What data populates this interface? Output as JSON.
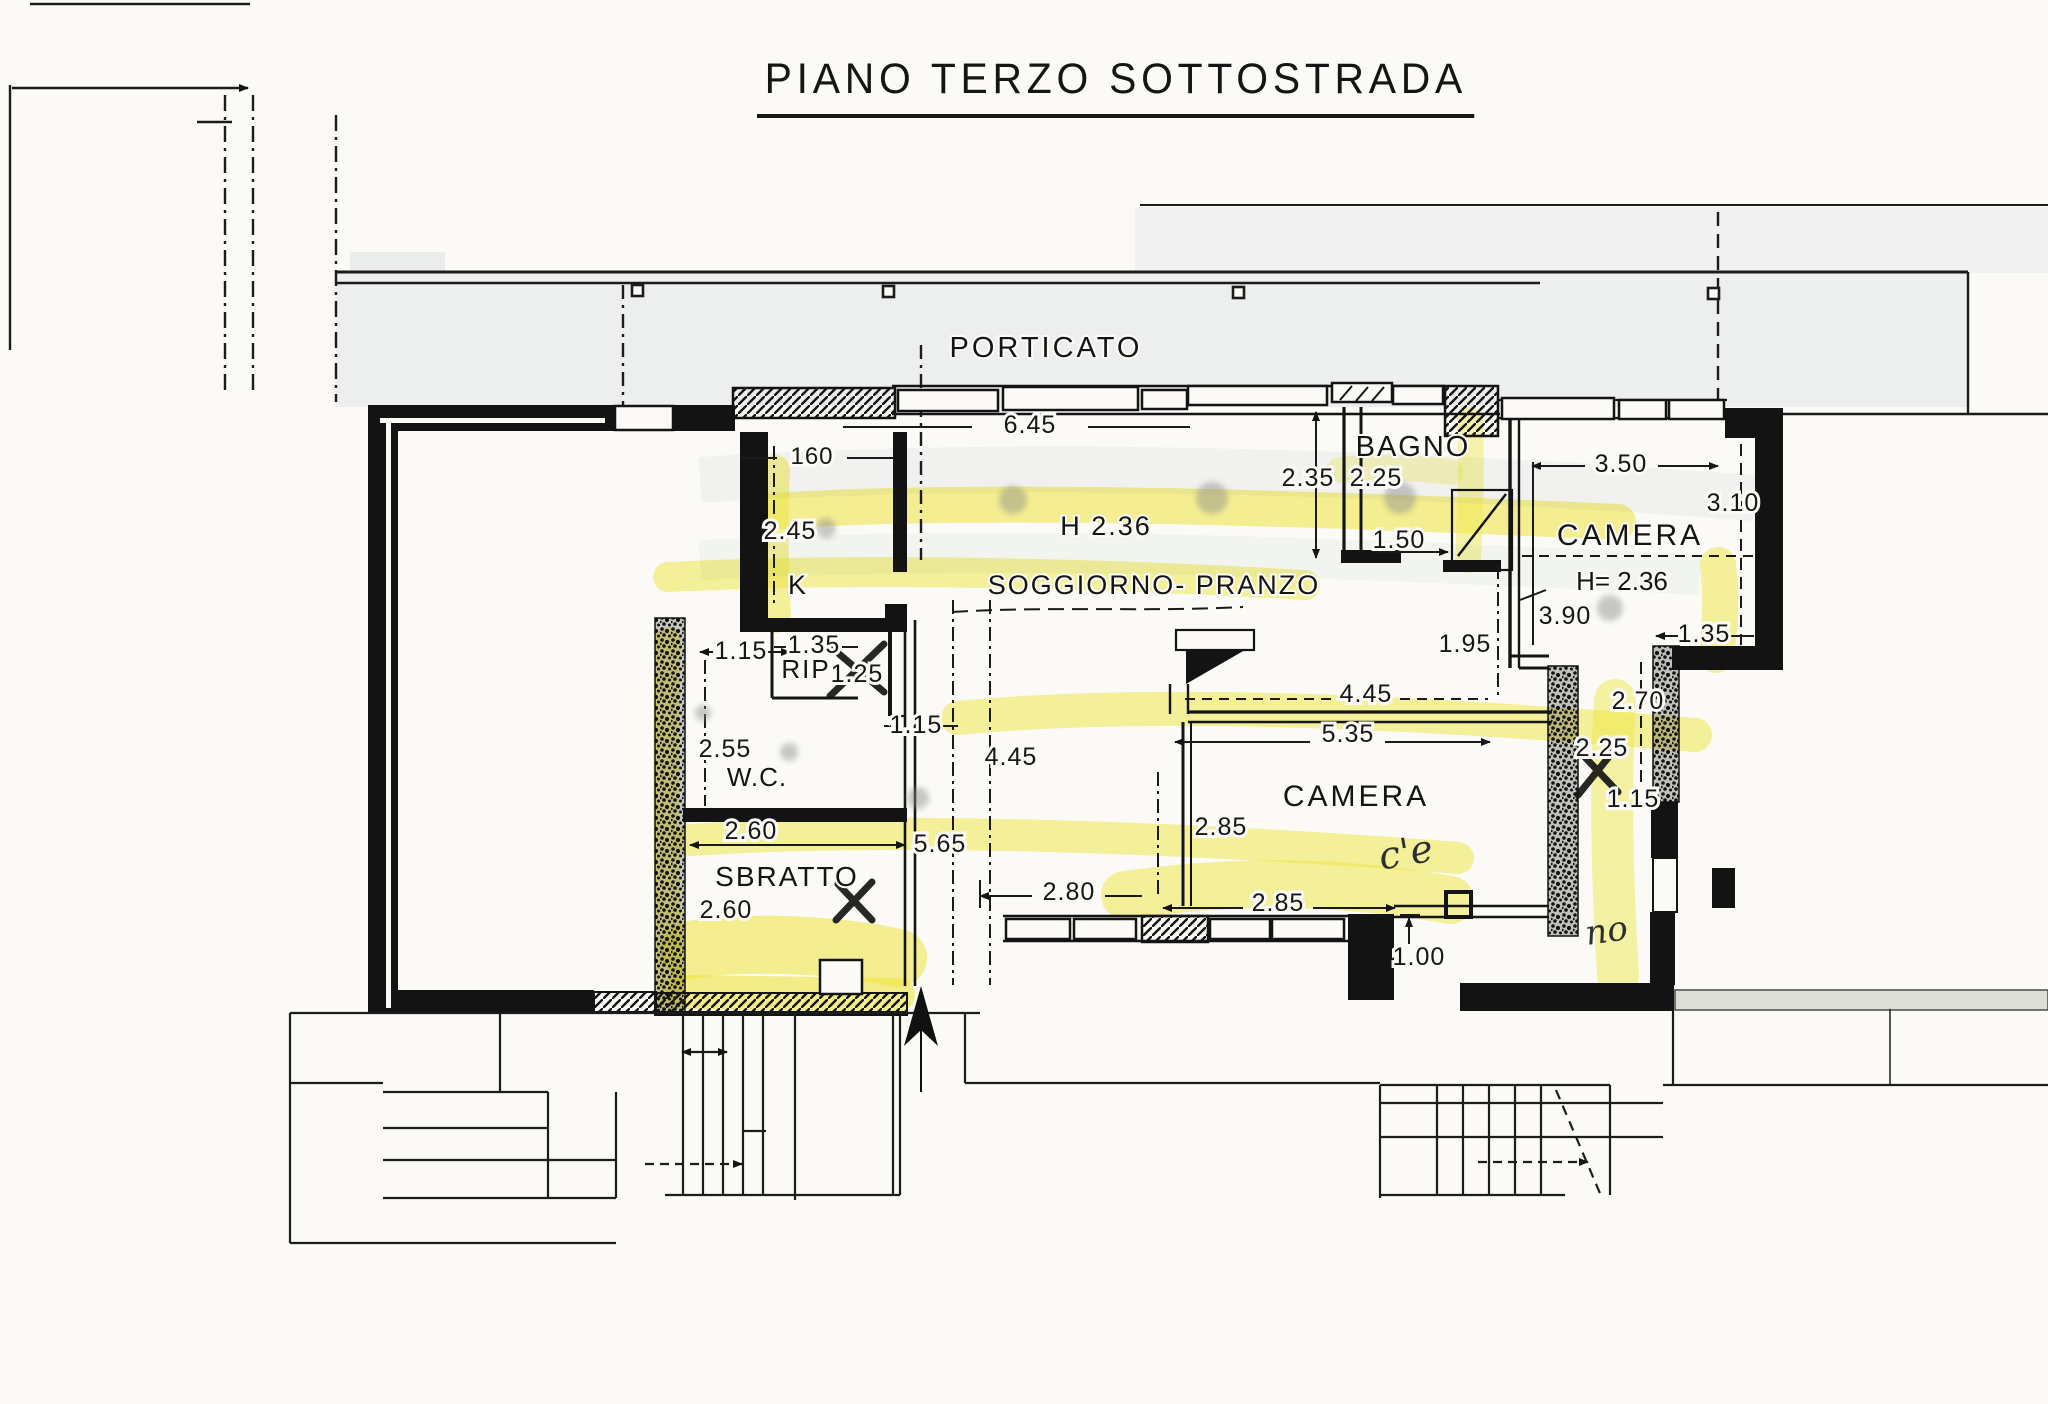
{
  "title": "PIANO TERZO SOTTOSTRADA",
  "colors": {
    "ink": "#1b1b1b",
    "paper": "#fbfaf6",
    "highlighter_yellow": "#f2ea3f",
    "walkway_gray": "#e7e9ec"
  },
  "plan": {
    "rooms": [
      {
        "label": "PORTICATO",
        "x": 1046,
        "y": 357,
        "fs": 29,
        "ls": 3
      },
      {
        "label": "BAGNO",
        "x": 1413,
        "y": 456,
        "fs": 29,
        "ls": 2
      },
      {
        "label": "CAMERA",
        "x": 1630,
        "y": 545,
        "fs": 30,
        "ls": 3
      },
      {
        "label": "H= 2.36",
        "x": 1622,
        "y": 590,
        "fs": 26,
        "ls": 0
      },
      {
        "label": "SOGGIORNO- PRANZO",
        "x": 1154,
        "y": 594,
        "fs": 27,
        "ls": 2
      },
      {
        "label": "H  2.36",
        "x": 1106,
        "y": 535,
        "fs": 27,
        "ls": 2
      },
      {
        "label": "K",
        "x": 797,
        "y": 594,
        "fs": 27,
        "ls": 0
      },
      {
        "label": "RIP",
        "x": 806,
        "y": 678,
        "fs": 26,
        "ls": 2
      },
      {
        "label": "W.C.",
        "x": 757,
        "y": 786,
        "fs": 26,
        "ls": 1
      },
      {
        "label": "SBRATTO",
        "x": 787,
        "y": 886,
        "fs": 28,
        "ls": 2
      },
      {
        "label": "CAMERA",
        "x": 1356,
        "y": 806,
        "fs": 30,
        "ls": 3
      }
    ],
    "dimensions": [
      {
        "value": "6.45",
        "x": 1030,
        "y": 433
      },
      {
        "value": "160",
        "x": 812,
        "y": 464,
        "fs": 24
      },
      {
        "value": "2.45",
        "x": 790,
        "y": 539
      },
      {
        "value": "2.35",
        "x": 1308,
        "y": 486
      },
      {
        "value": "2.25",
        "x": 1376,
        "y": 486
      },
      {
        "value": "1.50",
        "x": 1399,
        "y": 548
      },
      {
        "value": "3.50",
        "x": 1621,
        "y": 472
      },
      {
        "value": "3.10",
        "x": 1733,
        "y": 511
      },
      {
        "value": "3.90",
        "x": 1565,
        "y": 624
      },
      {
        "value": "1.95",
        "x": 1465,
        "y": 652
      },
      {
        "value": "1.35",
        "x": 1704,
        "y": 642
      },
      {
        "value": "2.70",
        "x": 1638,
        "y": 709
      },
      {
        "value": "2.25",
        "x": 1602,
        "y": 756,
        "crossed": true
      },
      {
        "value": "1.15",
        "x": 1633,
        "y": 807
      },
      {
        "value": "1.35",
        "x": 814,
        "y": 653
      },
      {
        "value": "1.15",
        "x": 741,
        "y": 659
      },
      {
        "value": "1.25",
        "x": 857,
        "y": 682,
        "crossed": true
      },
      {
        "value": "1.15",
        "x": 916,
        "y": 733
      },
      {
        "value": "2.55",
        "x": 725,
        "y": 757
      },
      {
        "value": "2.60",
        "x": 751,
        "y": 839
      },
      {
        "value": "2.60",
        "x": 726,
        "y": 918
      },
      {
        "value": "5.65",
        "x": 940,
        "y": 852
      },
      {
        "value": "4.45",
        "x": 1011,
        "y": 765
      },
      {
        "value": "4.45",
        "x": 1366,
        "y": 702
      },
      {
        "value": "5.35",
        "x": 1348,
        "y": 742
      },
      {
        "value": "2.85",
        "x": 1221,
        "y": 835
      },
      {
        "value": "2.85",
        "x": 1278,
        "y": 911
      },
      {
        "value": "2.80",
        "x": 1069,
        "y": 900
      },
      {
        "value": "1.00",
        "x": 1419,
        "y": 965
      }
    ],
    "annotations": [
      {
        "text": "c'e",
        "x": 1408,
        "y": 865,
        "fs": 38,
        "rot": -10
      },
      {
        "text": "no",
        "x": 1608,
        "y": 942,
        "fs": 34,
        "rot": -8
      }
    ]
  }
}
